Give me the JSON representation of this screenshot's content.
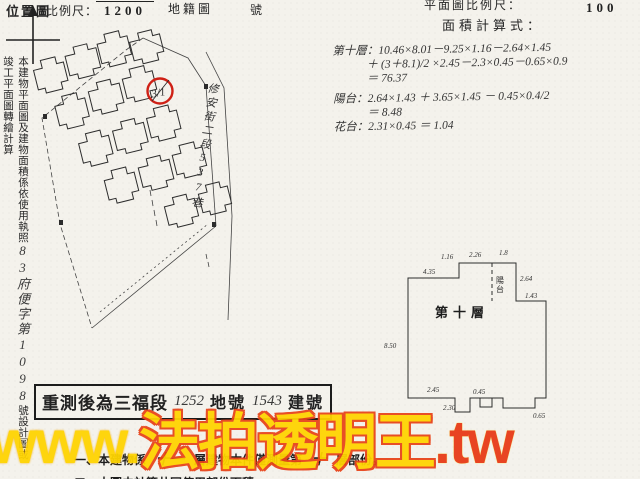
{
  "header": {
    "left": {
      "title": "位置圖",
      "scale_label": "比例尺：",
      "scale_denominator": "1200",
      "map_type": "地籍圖",
      "number_suffix": "號"
    },
    "right": {
      "plan_scale_label": "平面圖比例尺：",
      "plan_scale_denominator": "100",
      "formula_label": "面積計算式："
    }
  },
  "left_margin": {
    "printed_prefix": "本建物平面圖及建物面積係依使用執照",
    "handwritten_permit": "83府便字第1098",
    "printed_suffix": "號設計圖或竣工平面圖轉繪計算"
  },
  "site_plan": {
    "street_label": "修安街二段537巷",
    "lot_mark": "3/1",
    "circle_color": "#cf2015"
  },
  "calculations": {
    "lines": [
      {
        "text": "第十層：10.46×8.01－9.25×1.16－2.64×1.45",
        "indent": 0,
        "gap": false
      },
      {
        "text": "＋ (3＋8.1)/2 ×2.45－2.3×0.45－0.65×0.9",
        "indent": 1,
        "gap": false
      },
      {
        "text": "＝ 76.37",
        "indent": 1,
        "gap": false
      },
      {
        "text": "陽台：2.64×1.43 ＋ 3.65×1.45 － 0.45×0.4/2",
        "indent": 0,
        "gap": true
      },
      {
        "text": "＝ 8.48",
        "indent": 1,
        "gap": false
      },
      {
        "text": "花台：2.31×0.45 ＝ 1.04",
        "indent": 0,
        "gap": false
      }
    ]
  },
  "floor_plan": {
    "room_label": "第十層",
    "balcony_label": "陽台",
    "dims": [
      {
        "t": "4.35",
        "x": 40,
        "y": 36
      },
      {
        "t": "1.16",
        "x": 58,
        "y": 21
      },
      {
        "t": "2.26",
        "x": 86,
        "y": 19
      },
      {
        "t": "1.8",
        "x": 116,
        "y": 17
      },
      {
        "t": "2.64",
        "x": 137,
        "y": 43
      },
      {
        "t": "1.43",
        "x": 142,
        "y": 60
      },
      {
        "t": "8.50",
        "x": 1,
        "y": 110
      },
      {
        "t": "2.45",
        "x": 44,
        "y": 154
      },
      {
        "t": "0.45",
        "x": 90,
        "y": 156
      },
      {
        "t": "2.30",
        "x": 60,
        "y": 172
      },
      {
        "t": "0.65",
        "x": 150,
        "y": 180
      }
    ]
  },
  "stamp": {
    "prefix": "重測後為三福段",
    "lot_number": "1252",
    "lot_label": "地號",
    "building_number": "1543",
    "building_label": "建號"
  },
  "notes": {
    "line1": {
      "pre": "一、本建物係",
      "floors": "十一",
      "mid": "層建物本件僅測量第",
      "floor": "十",
      "suf": "層部份。"
    },
    "line2": "二、本圖未計算共同使用部份面積。"
  },
  "watermark": {
    "www": "www.",
    "name": "法拍透明王",
    "tld": ".tw",
    "yellow": "#ffd400",
    "red": "#e8441a"
  }
}
